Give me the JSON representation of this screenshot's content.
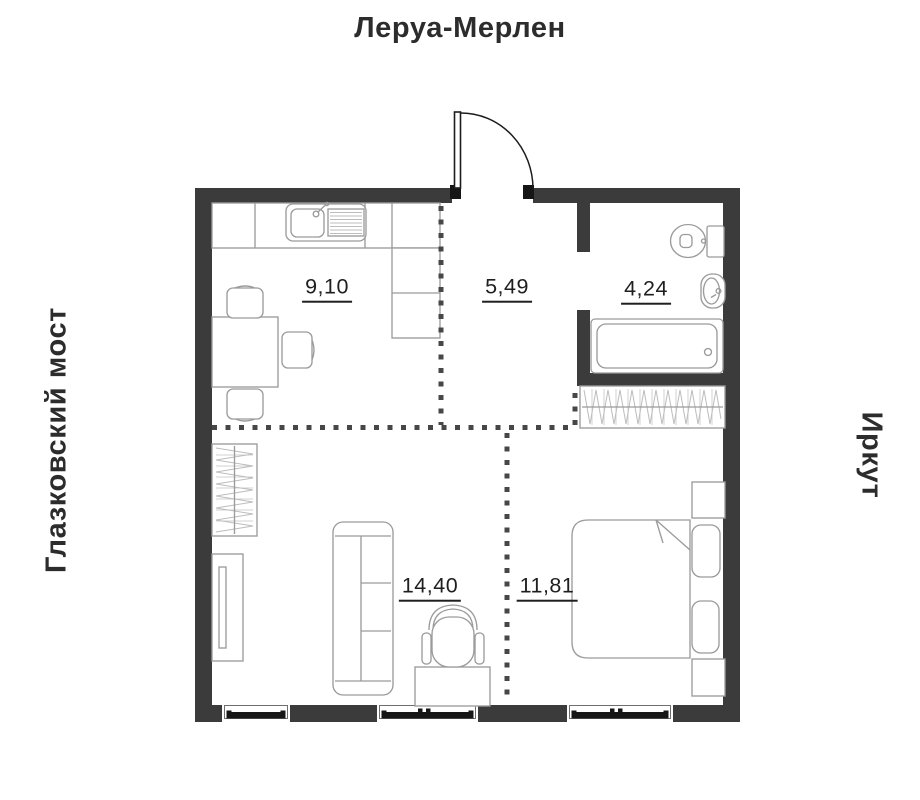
{
  "surroundings": {
    "top": "Леруа-Мерлен",
    "left": "Глазковский мост",
    "right": "Иркут"
  },
  "rooms": [
    {
      "name": "kitchen",
      "area_m2": "9,10",
      "furniture": [
        "counter",
        "sink",
        "dining-table",
        "chairs"
      ]
    },
    {
      "name": "hallway",
      "area_m2": "5,49",
      "furniture": [
        "entrance-door"
      ]
    },
    {
      "name": "bathroom",
      "area_m2": "4,24",
      "furniture": [
        "toilet",
        "sink",
        "bathtub"
      ]
    },
    {
      "name": "living-room",
      "area_m2": "14,40",
      "furniture": [
        "wardrobe",
        "tv-cabinet",
        "sofa",
        "desk",
        "office-chair"
      ]
    },
    {
      "name": "bedroom",
      "area_m2": "11,81",
      "furniture": [
        "wardrobe",
        "double-bed",
        "nightstands"
      ]
    }
  ],
  "colors": {
    "wall": "#3b3b3b",
    "furniture_line": "#9b9b9b",
    "dashed_line": "#474747",
    "text": "#2c2c2c",
    "label": "#1f1f1f"
  }
}
